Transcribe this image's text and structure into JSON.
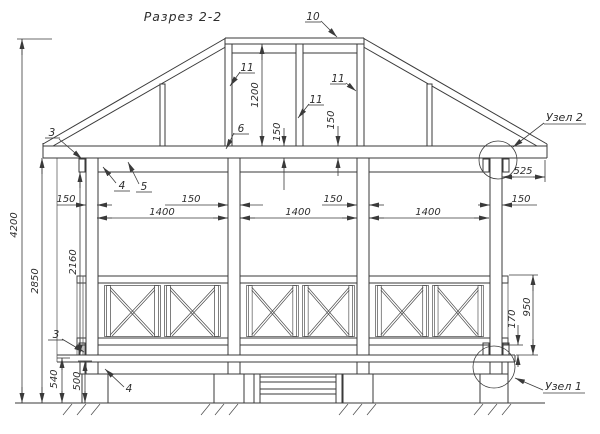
{
  "title": "Разрез 2-2",
  "callouts": {
    "c3_top": "3",
    "c4_top": "4",
    "c5": "5",
    "c6": "6",
    "c10": "10",
    "c11_left": "11",
    "c11_mid": "11",
    "c11_right": "11",
    "c3_bottom": "3",
    "c4_bottom": "4"
  },
  "nodes": {
    "node2": "Узел 2",
    "node1": "Узел 1"
  },
  "dims": {
    "total_height": "4200",
    "ground_to_ceiling": "2850",
    "floor_to_ceiling": "2160",
    "ground_to_deck": "540",
    "ground_to_joist": "500",
    "roof_height": "1200",
    "roof_band_left": "150",
    "roof_band_right": "150",
    "post1": "150",
    "post2": "150",
    "post3": "150",
    "post4": "150",
    "bay1": "1400",
    "bay2": "1400",
    "bay3": "1400",
    "eave_overhang": "525",
    "rail_gap": "170",
    "railing_height": "950"
  },
  "colors": {
    "line": "#3a3a3a",
    "background": "#ffffff"
  }
}
